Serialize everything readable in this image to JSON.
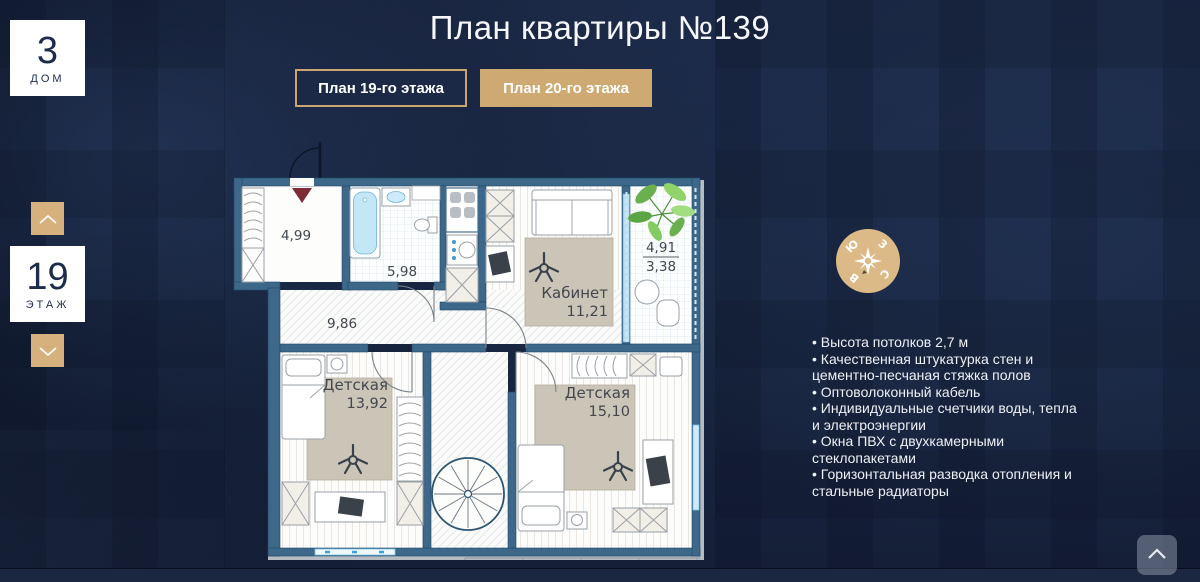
{
  "header": {
    "title": "План квартиры №139"
  },
  "house_badge": {
    "value": "3",
    "label": "ДОМ"
  },
  "floor_badge": {
    "value": "19",
    "label": "ЭТАЖ"
  },
  "tabs": {
    "floor19_label": "План 19-го этажа",
    "floor20_label": "План 20-го этажа"
  },
  "plan": {
    "rooms": {
      "hall": {
        "area": "4,99"
      },
      "bathroom": {
        "area": "5,98"
      },
      "corridor": {
        "area": "9,86"
      },
      "office": {
        "name": "Кабинет",
        "area": "11,21"
      },
      "balcony": {
        "area_total": "4,91",
        "area_reduced": "3,38"
      },
      "kids_room_1": {
        "name": "Детская",
        "area": "13,92"
      },
      "kids_room_2": {
        "name": "Детская",
        "area": "15,10"
      }
    }
  },
  "compass": {
    "north": "С",
    "south": "Ю",
    "east": "В",
    "west": "З"
  },
  "features": {
    "items": [
      "Высота потолков 2,7 м",
      "Качественная штукатурка стен и цементно-песчаная стяжка полов",
      "Оптоволоконный кабель",
      "Индивидуальные счетчики воды, тепла и электроэнергии",
      "Окна ПВХ с двухкамерными стеклопакетами",
      "Горизонтальная разводка отопления и стальные радиаторы"
    ]
  },
  "colors": {
    "accent_gold": "#cfa972",
    "button_gold": "#d6b17e",
    "compass_gold": "#dcba87",
    "background_navy": "#1a2642",
    "wall_teal": "#3d688a"
  }
}
